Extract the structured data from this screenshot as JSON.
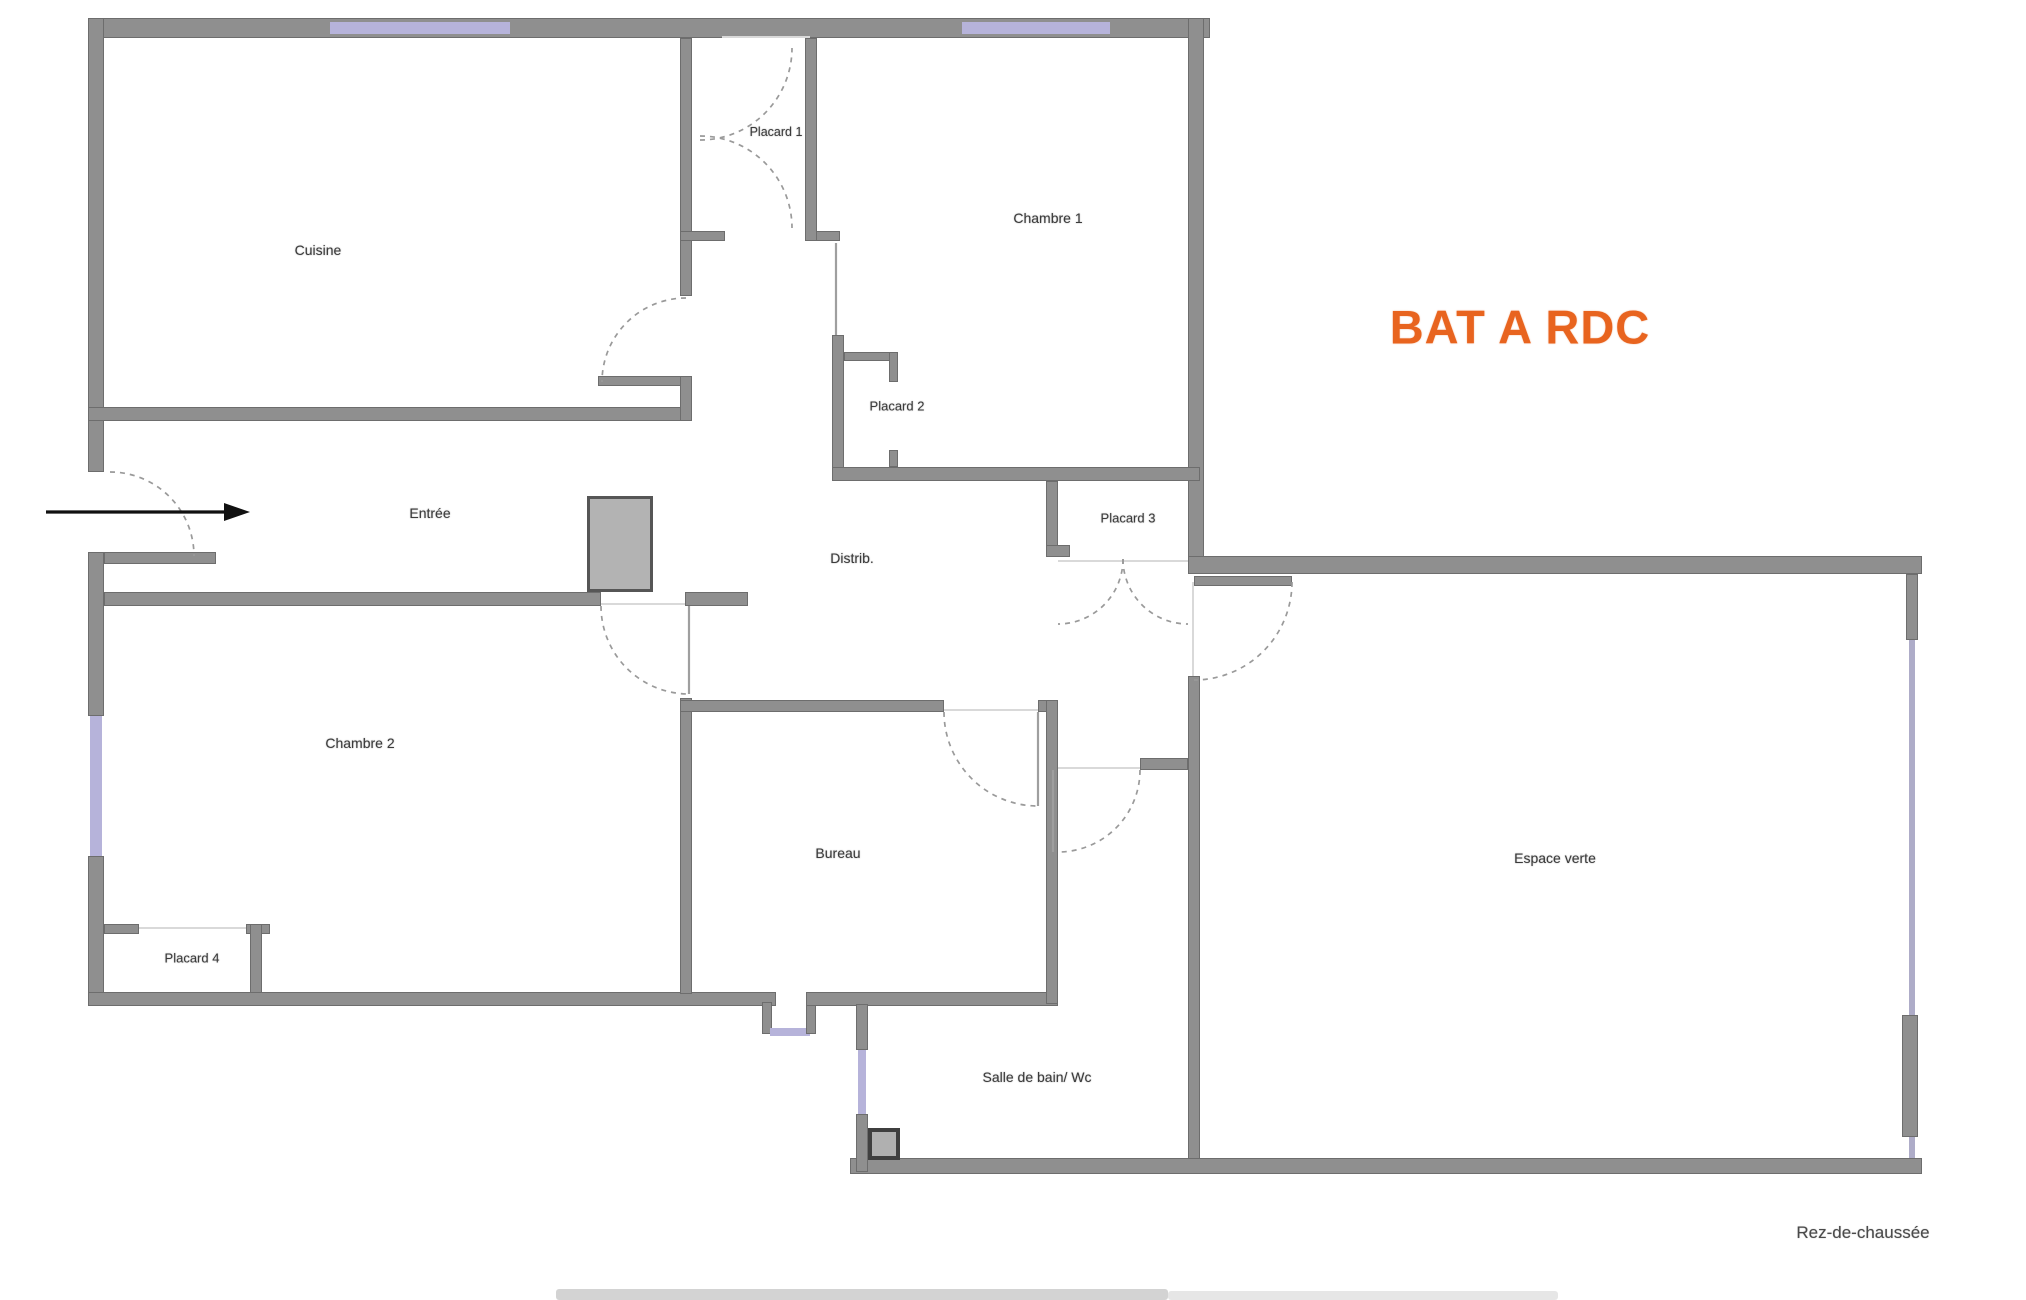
{
  "title": {
    "text": "BAT A RDC",
    "color": "#e8641f"
  },
  "footer": {
    "text": "Rez-de-chaussée"
  },
  "rooms": {
    "cuisine": {
      "label": "Cuisine"
    },
    "placard1": {
      "label": "Placard 1"
    },
    "chambre1": {
      "label": "Chambre 1"
    },
    "placard2": {
      "label": "Placard 2"
    },
    "placard3": {
      "label": "Placard 3"
    },
    "entree": {
      "label": "Entrée"
    },
    "distrib": {
      "label": "Distrib."
    },
    "chambre2": {
      "label": "Chambre 2"
    },
    "bureau": {
      "label": "Bureau"
    },
    "placard4": {
      "label": "Placard 4"
    },
    "salle_de_bain": {
      "label": "Salle de bain/ Wc"
    },
    "espace_verte": {
      "label": "Espace verte"
    }
  },
  "colors": {
    "wall": "#8f8f8f",
    "window": "#b6b3da",
    "door_arc": "#9a9a9a",
    "title": "#e8641f",
    "entry_arrow": "#111111"
  }
}
